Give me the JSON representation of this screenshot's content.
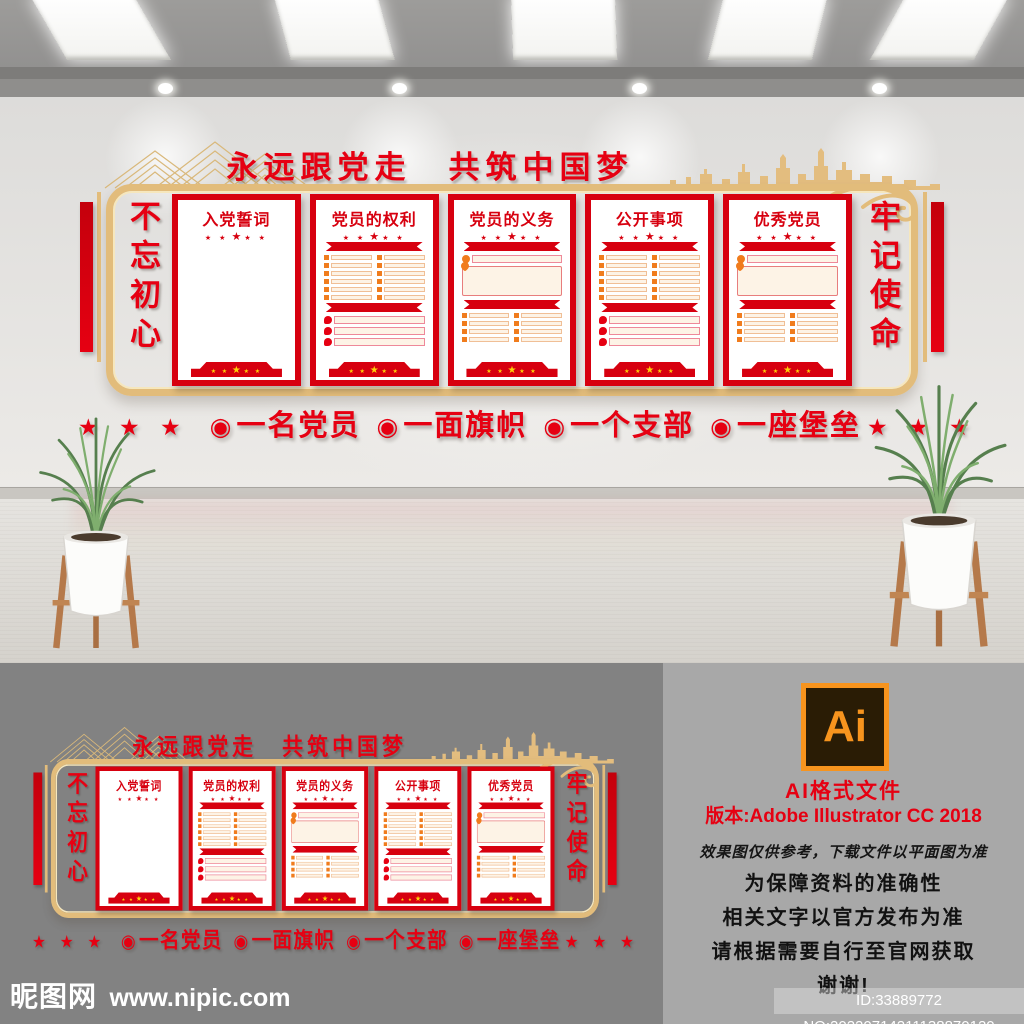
{
  "colors": {
    "red": "#e60012",
    "panel-red": "#d7000f",
    "gold": "#e2bc7b",
    "gold-light": "#f6e7bd",
    "cream": "#fdf3e6",
    "orange": "#f07c1d",
    "star-gold": "#ffd10a",
    "ai-orange": "#f7941e",
    "ai-bg": "#2a1c05",
    "flat-bg": "#828282",
    "info-bg": "#a8a8a8"
  },
  "wall": {
    "banner_title": "永远跟党走　共筑中国梦",
    "left_vertical": "不忘初心",
    "right_vertical": "牢记使命",
    "title_stars": {
      "small": "★ ★",
      "big": "★"
    },
    "footer_stars": {
      "small": "★ ★",
      "big": "★"
    },
    "panels": [
      {
        "title": "入党誓词",
        "layout": "blank"
      },
      {
        "title": "党员的权利",
        "layout": "list-top"
      },
      {
        "title": "党员的义务",
        "layout": "box-top"
      },
      {
        "title": "公开事项",
        "layout": "list-top"
      },
      {
        "title": "优秀党员",
        "layout": "box-top"
      }
    ],
    "slogan": {
      "stars": "★ ★ ★",
      "bullet": "◉",
      "items": [
        "一名党员",
        "一面旗帜",
        "一个支部",
        "一座堡垒"
      ]
    }
  },
  "info": {
    "logo_text": "Ai",
    "format_line": "AI格式文件",
    "version_line": "版本:Adobe Illustrator  CC 2018",
    "note_italic": "效果图仅供参考，下载文件以平面图为准",
    "note_lines": [
      "为保障资料的准确性",
      "相关文字以官方发布为准",
      "请根据需要自行至官网获取",
      "谢谢!"
    ],
    "id_badge": "ID:33889772 NO:20220714211138870120"
  },
  "watermark": {
    "site_name": "昵图网",
    "site_url": "www.nipic.com"
  }
}
